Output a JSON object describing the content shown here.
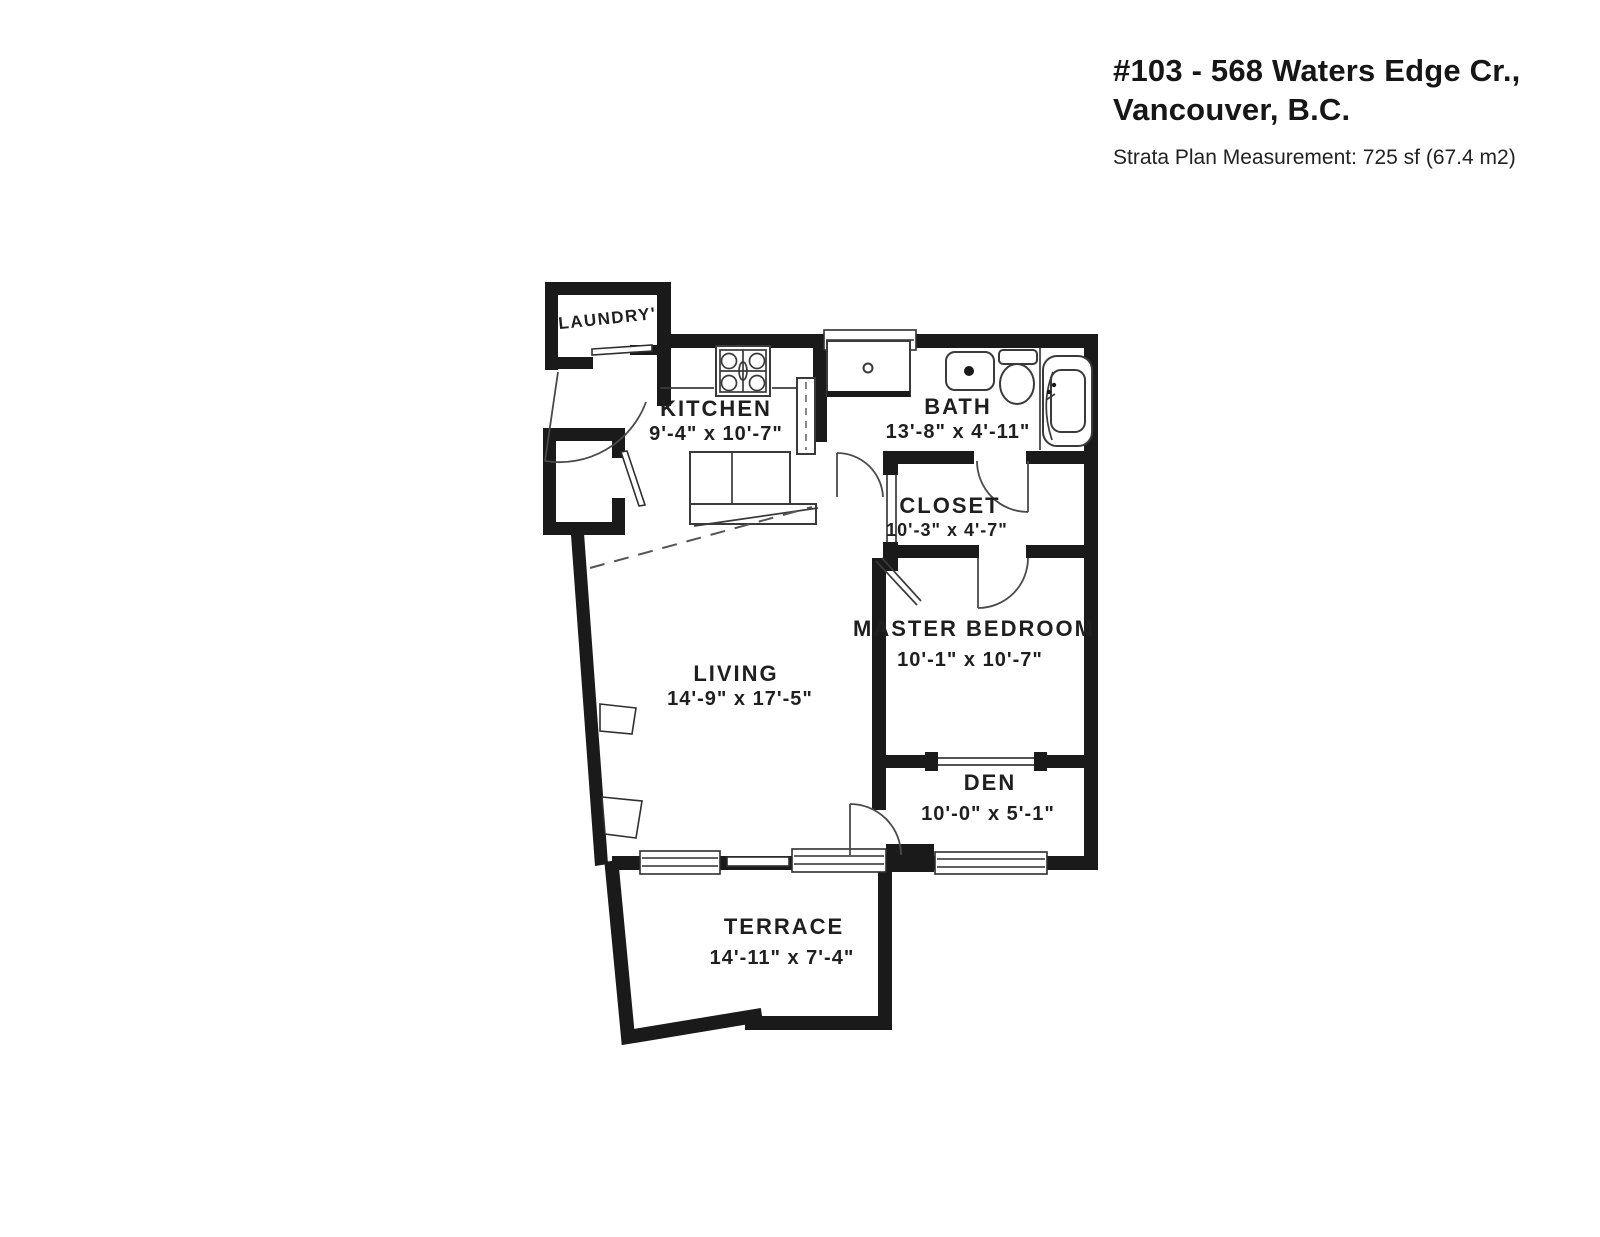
{
  "page": {
    "background": "#ffffff"
  },
  "header": {
    "title_line1": "#103 - 568 Waters Edge Cr.,",
    "title_line2": "Vancouver, B.C.",
    "subtitle": "Strata Plan Measurement: 725 sf (67.4 m2)"
  },
  "colors": {
    "wall": "#1a1a1a",
    "thin_line": "#3a3a3a",
    "label": "#1f1f1f",
    "background": "#ffffff"
  },
  "rooms": {
    "laundry": {
      "name": "LAUNDRY'",
      "dims": ""
    },
    "kitchen": {
      "name": "KITCHEN",
      "dims": "9'-4\" x 10'-7\""
    },
    "bath": {
      "name": "BATH",
      "dims": "13'-8\" x 4'-11\""
    },
    "closet": {
      "name": "CLOSET",
      "dims": "10'-3\" x 4'-7\""
    },
    "master_bedroom": {
      "name": "MASTER BEDROOM",
      "dims": "10'-1\" x 10'-7\""
    },
    "living": {
      "name": "LIVING",
      "dims": "14'-9\" x 17'-5\""
    },
    "den": {
      "name": "DEN",
      "dims": "10'-0\" x 5'-1\""
    },
    "terrace": {
      "name": "TERRACE",
      "dims": "14'-11\" x 7'-4\""
    }
  },
  "fixtures": [
    "stove-icon",
    "kitchen-counter",
    "kitchen-island",
    "bath-vanity",
    "bath-sink-icon",
    "toilet-icon",
    "bathtub-icon",
    "window-glyph",
    "door-swing-glyph",
    "sliding-door-glyph"
  ]
}
